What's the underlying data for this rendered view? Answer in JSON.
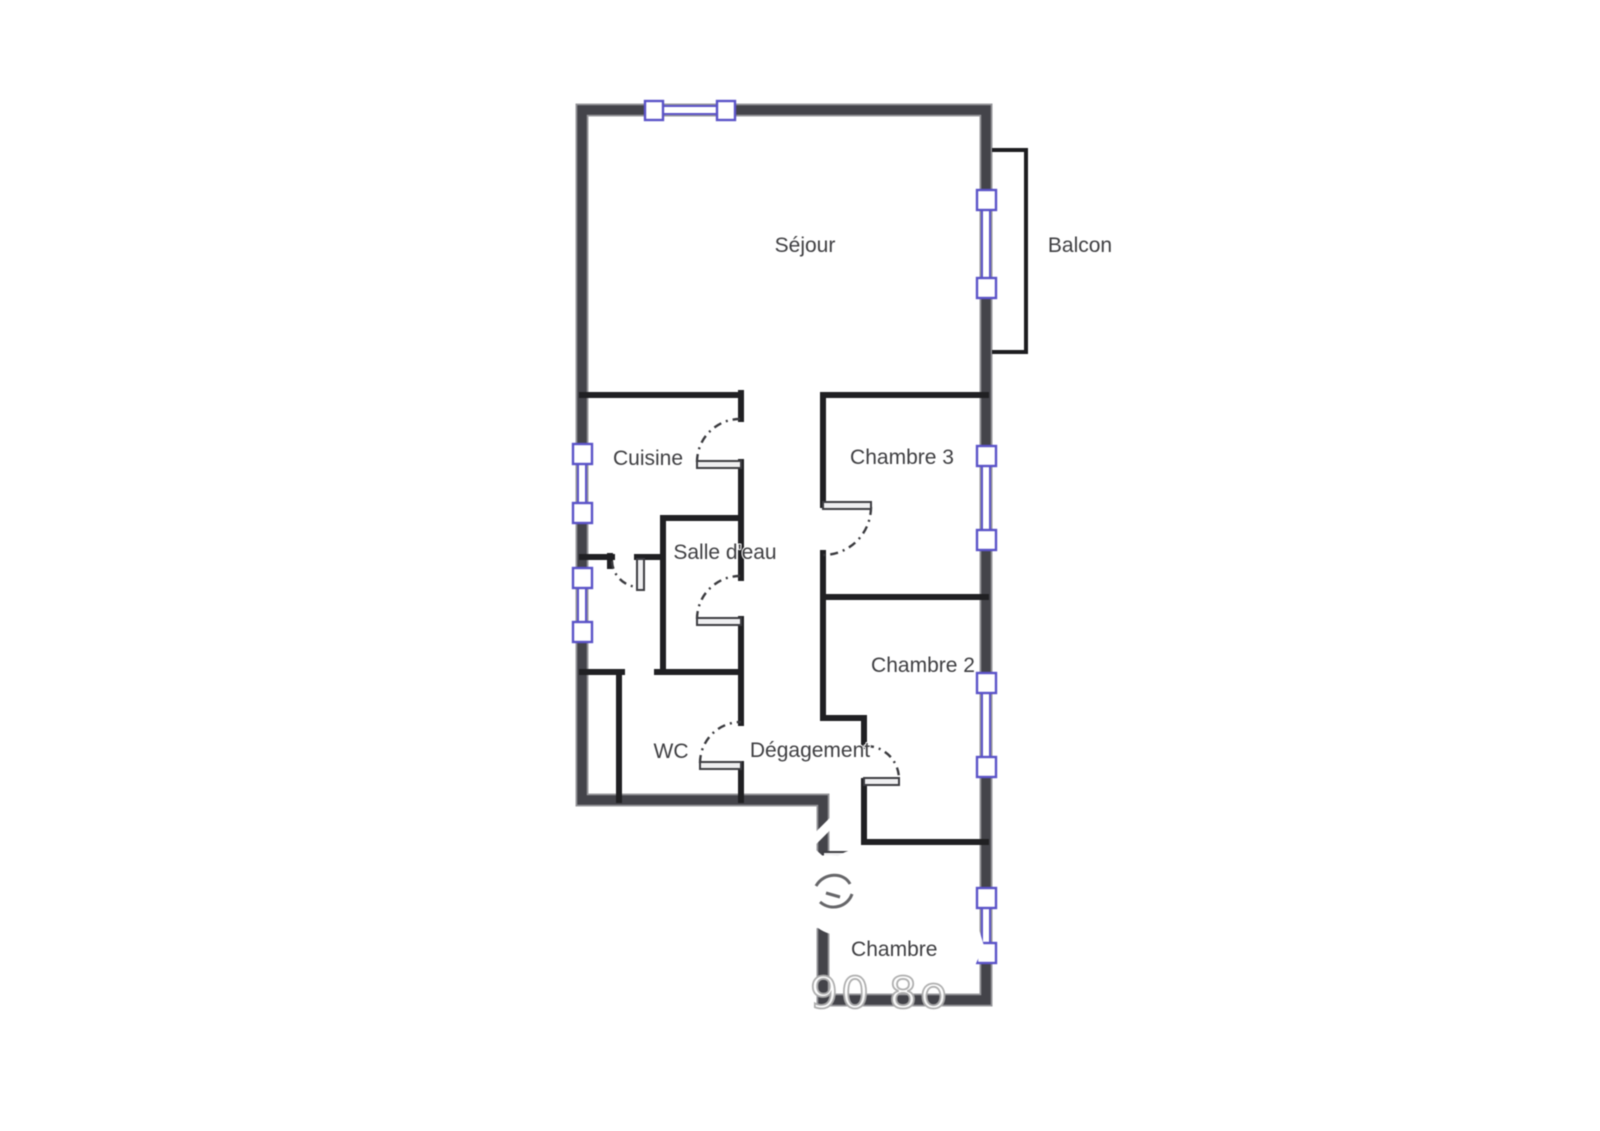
{
  "floorplan": {
    "rooms": {
      "sejour": {
        "label": "Séjour"
      },
      "balcon": {
        "label": "Balcon"
      },
      "cuisine": {
        "label": "Cuisine"
      },
      "chambre3": {
        "label": "Chambre 3"
      },
      "salle_deau": {
        "label": "Salle d'eau"
      },
      "chambre2": {
        "label": "Chambre 2"
      },
      "wc": {
        "label": "WC"
      },
      "degagement": {
        "label": "Dégagement"
      },
      "chambre1": {
        "label": "Chambre 1"
      }
    },
    "watermark": {
      "text": "90 8o"
    },
    "colors": {
      "wall_exterior": "#44444a",
      "wall_interior": "#202023",
      "door": "#3d3d42",
      "window_frame": "#5b53c8",
      "window_fill": "#ffffff",
      "label": "#3e3e41",
      "watermark": "#acacac",
      "background": "#ffffff"
    }
  }
}
